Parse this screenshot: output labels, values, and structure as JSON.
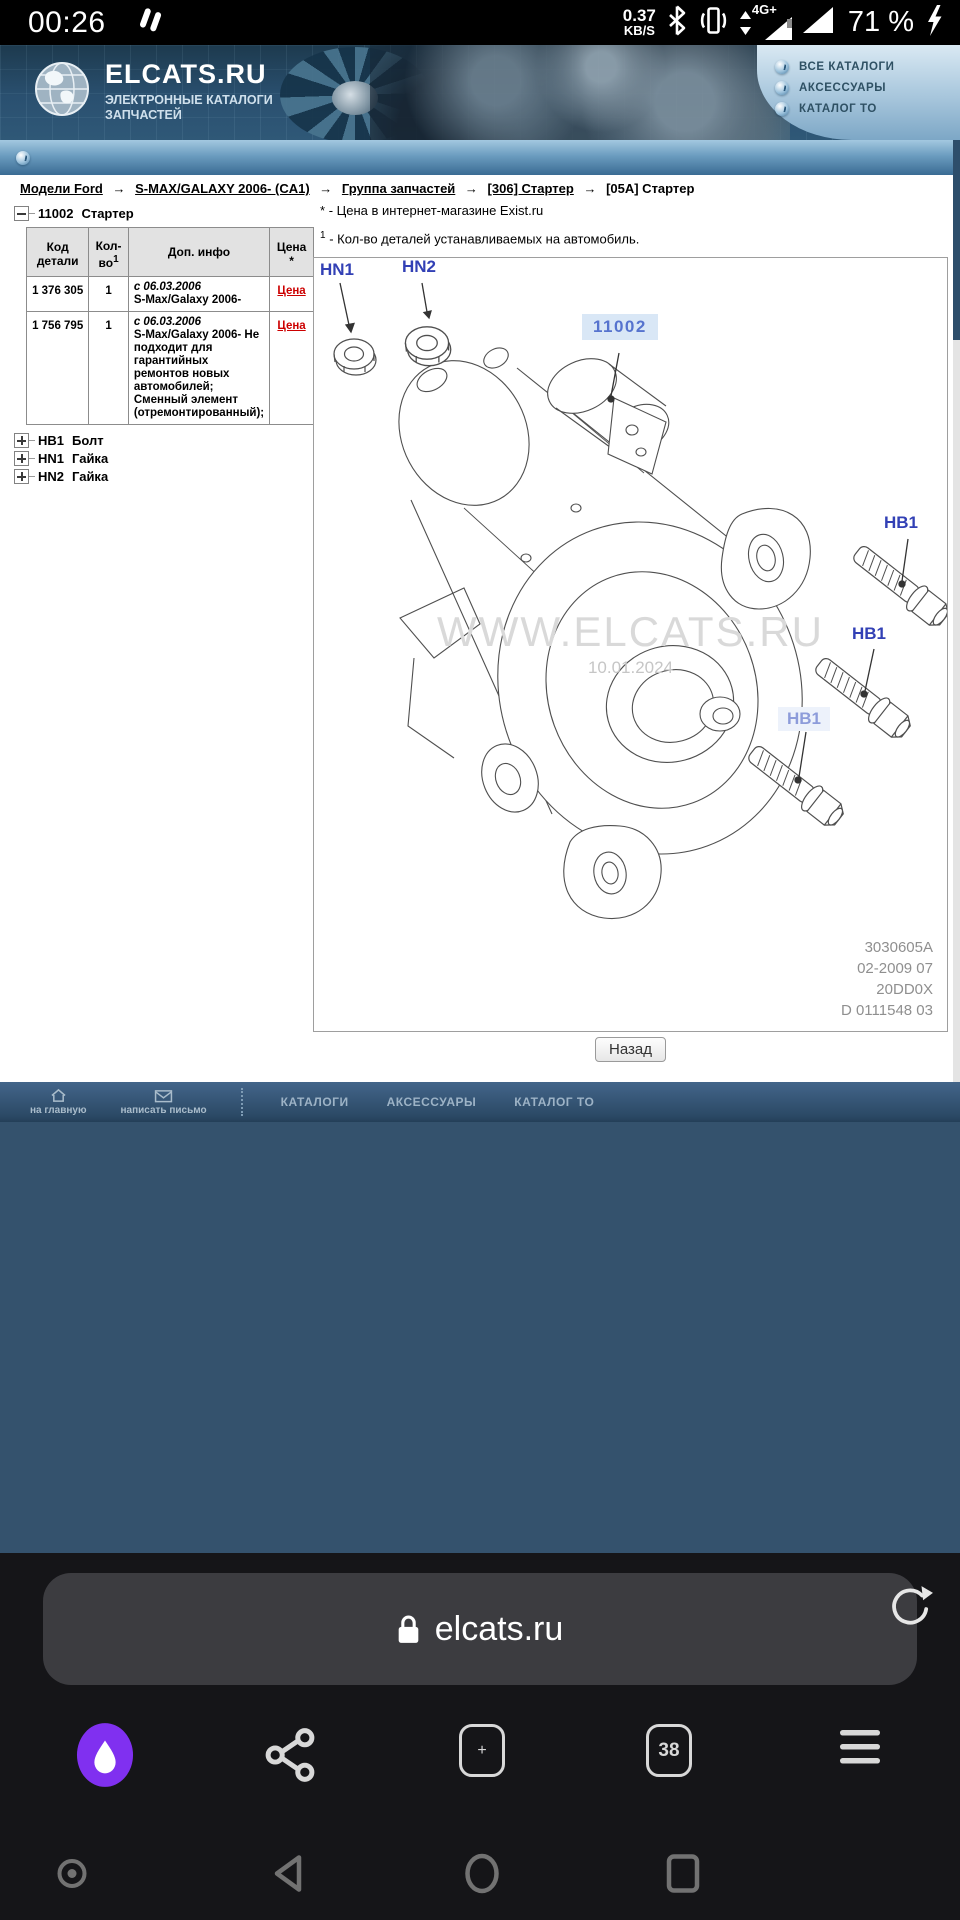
{
  "status_bar": {
    "time": "00:26",
    "net_speed_value": "0.37",
    "net_speed_unit": "KB/S",
    "network_label": "4G+",
    "battery_percent": "71 %",
    "icons": [
      "speed-indicator-icon",
      "bluetooth-icon",
      "vibrate-icon",
      "network-arrows-icon",
      "signal-triangle-icon",
      "signal-triangle-icon",
      "charging-bolt-icon"
    ]
  },
  "header": {
    "logo_title": "ELCATS.RU",
    "logo_subtitle_line1": "ЭЛЕКТРОННЫЕ КАТАЛОГИ",
    "logo_subtitle_line2": "ЗАПЧАСТЕЙ",
    "menu": [
      {
        "label": "ВСЕ КАТАЛОГИ"
      },
      {
        "label": "АКСЕССУАРЫ"
      },
      {
        "label": "КАТАЛОГ ТО"
      }
    ]
  },
  "breadcrumb": {
    "separator": "→",
    "items": [
      {
        "label": "Модели Ford",
        "link": true
      },
      {
        "label": "S-MAX/GALAXY 2006- (CA1)",
        "link": true
      },
      {
        "label": "Группа запчастей",
        "link": true
      },
      {
        "label": "[306] Стартер",
        "link": true
      },
      {
        "label": "[05A] Стартер",
        "link": false
      }
    ]
  },
  "parts_tree": {
    "root_code": "11002",
    "root_name": "Стартер",
    "items": [
      {
        "code": "НВ1",
        "name": "Болт"
      },
      {
        "code": "HN1",
        "name": "Гайка"
      },
      {
        "code": "HN2",
        "name": "Гайка"
      }
    ]
  },
  "parts_table": {
    "columns": {
      "code": "Код детали",
      "qty": "Кол-во",
      "qty_sup": "1",
      "info": "Доп. инфо",
      "price": "Цена",
      "price_mark": "*"
    },
    "rows": [
      {
        "code": "1 376 305",
        "qty": "1",
        "info_date": "с 06.03.2006",
        "info_text": "S-Max/Galaxy 2006-",
        "price_label": "Цена"
      },
      {
        "code": "1 756 795",
        "qty": "1",
        "info_date": "с 06.03.2006",
        "info_text": "S-Max/Galaxy 2006- Не подходит для гарантийных ремонтов новых автомобилей; Сменный элемент (отремонтированный);",
        "price_label": "Цена"
      }
    ]
  },
  "notes": {
    "note1_mark": "*",
    "note1_text": "- Цена в интернет-магазине Exist.ru",
    "note2_mark": "1",
    "note2_text": "- Кол-во деталей устанавливаемых на автомобиль."
  },
  "diagram": {
    "label_hn1": "HN1",
    "label_hn2": "HN2",
    "label_part": "11002",
    "label_hb1": "НВ1",
    "watermark": "WWW.ELCATS.RU",
    "watermark_date": "10.01.2024",
    "doc_numbers": [
      "3030605A",
      "02-2009 07",
      "20DD0X",
      "D 0111548 03"
    ]
  },
  "back_button_label": "Назад",
  "footer": {
    "home_label": "на главную",
    "mail_label": "написать письмо",
    "links": [
      "КАТАЛОГИ",
      "АКСЕССУАРЫ",
      "КАТАЛОГ ТО"
    ]
  },
  "browser": {
    "url": "elcats.ru",
    "tab_count": "38"
  },
  "icons": {
    "plus_glyph": "+"
  },
  "colors": {
    "accent_red": "#cc0000",
    "diagram_label_blue": "#3240b5",
    "header_dark_blue": "#2a5070",
    "body_teal": "#34526d",
    "alice_purple": "#8030f0"
  }
}
